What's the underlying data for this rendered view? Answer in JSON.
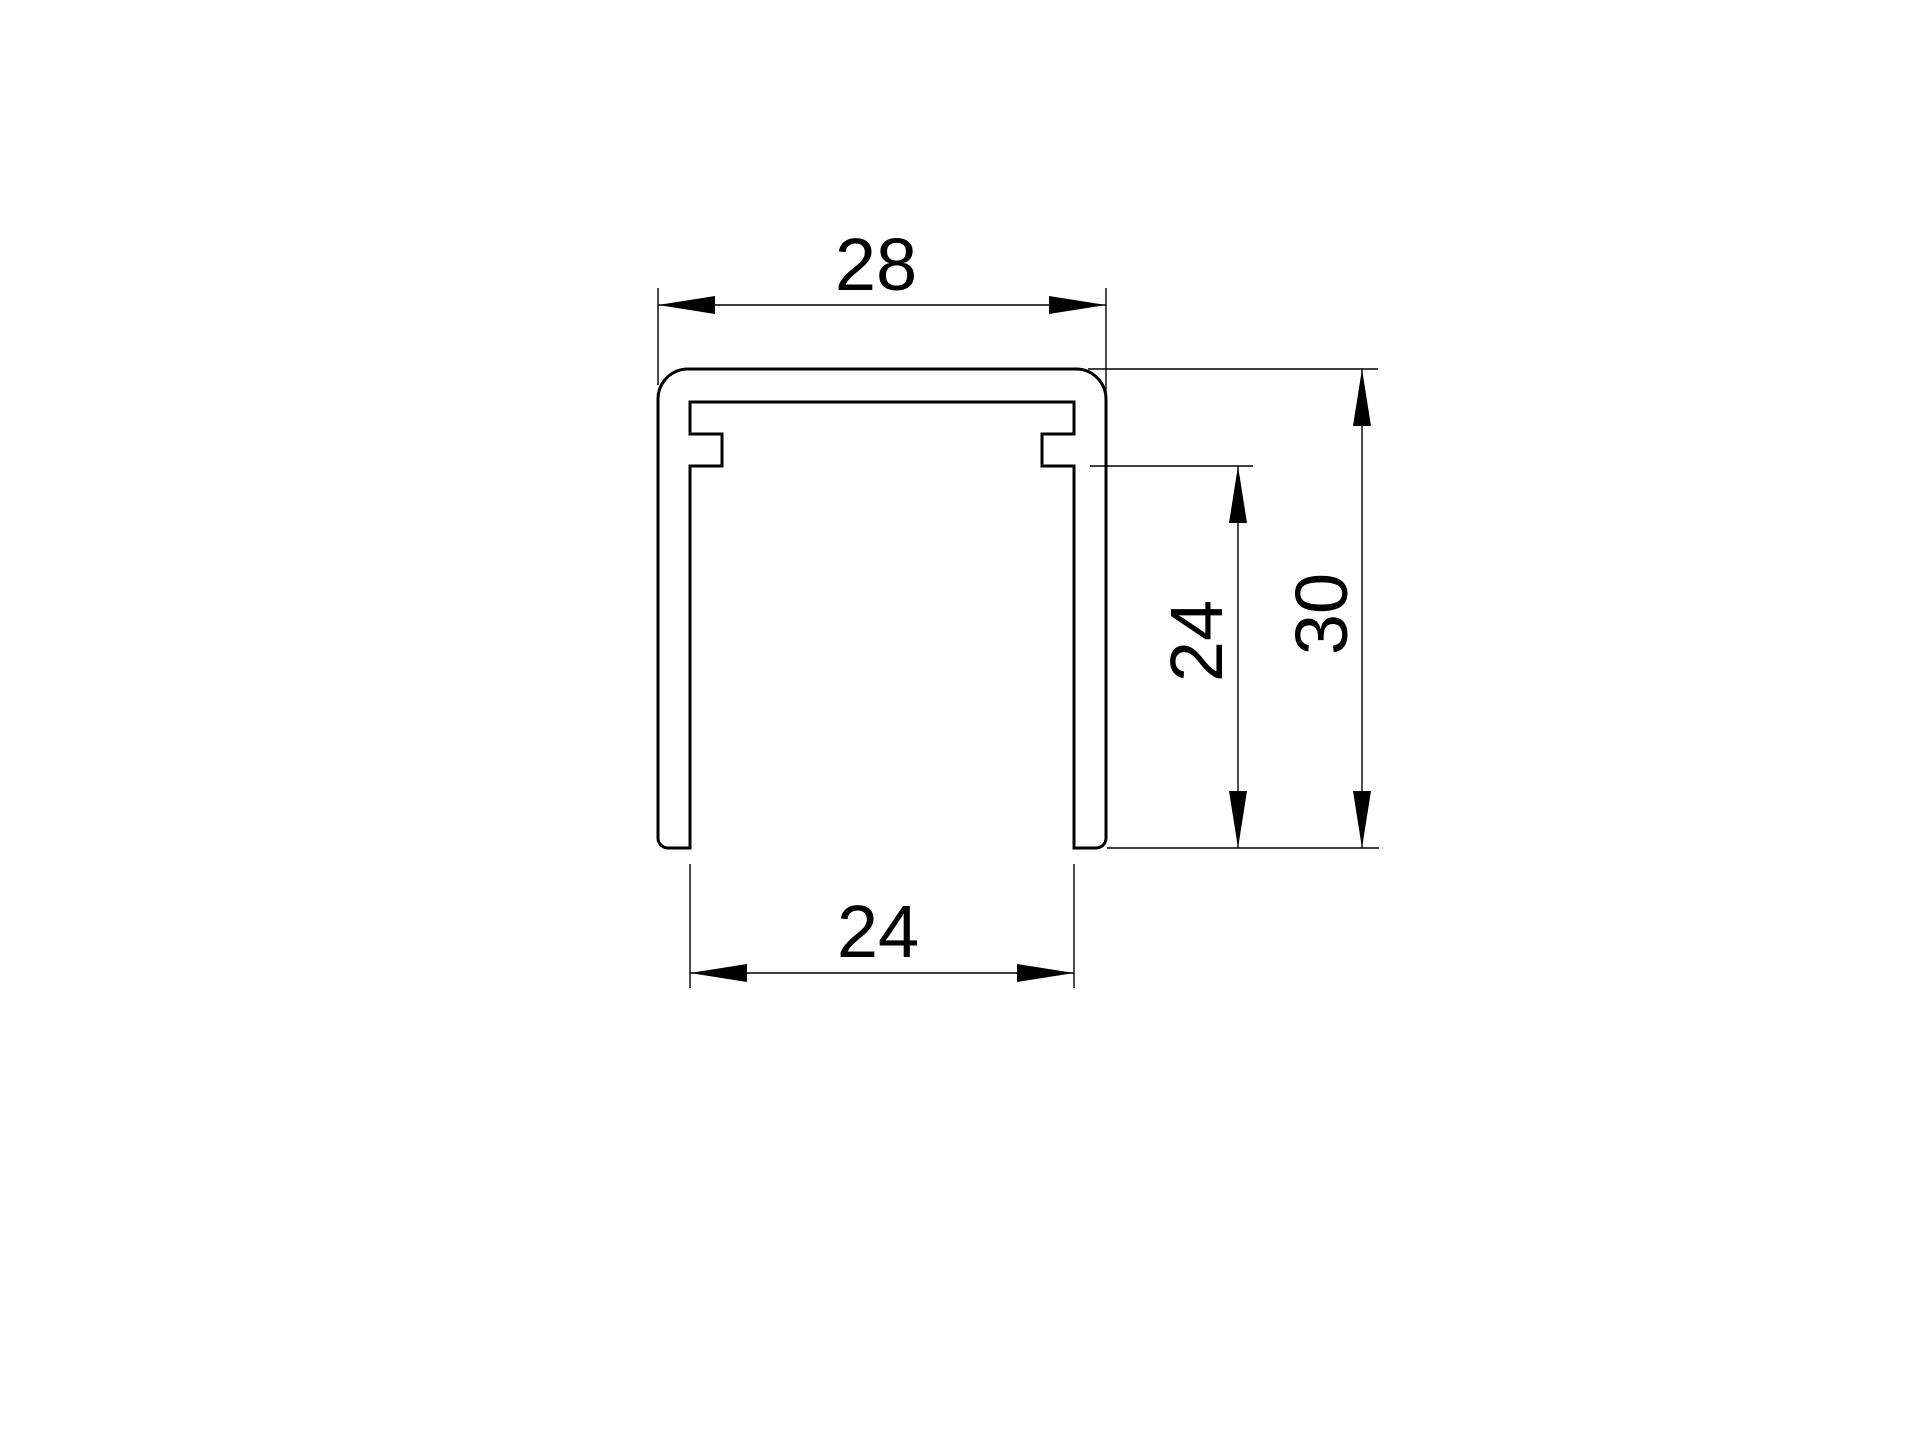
{
  "page": {
    "background_color": "#ffffff",
    "stroke_color": "#000000"
  },
  "drawing": {
    "description": "U-channel profile cross-section, technical drawing",
    "dimensions": {
      "top_width": {
        "value": "28"
      },
      "bottom_inner_width": {
        "value": "24"
      },
      "right_inner_height": {
        "value": "24"
      },
      "right_outer_height": {
        "value": "30"
      }
    }
  }
}
